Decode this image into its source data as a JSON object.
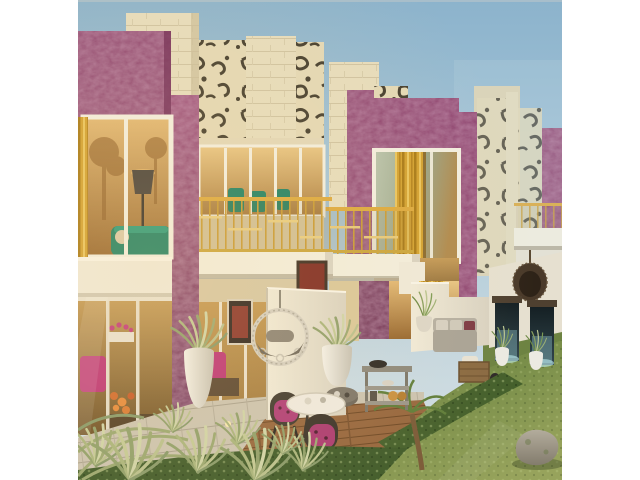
{
  "meta": {
    "kind": "architectural-rendering-photo",
    "description": "Row of modern two-storey townhouses with mottled purple feature walls, cream stone towers topped by leopard-print fretwork panels, gold balcony railings and gold curtains; landscaped ground level with white privacy walls, white planters of ornamental grass, a filigree ring swing chair, a dark hanging egg chair, wall water features, an outdoor sofa, a console cart, a round bistro table with two magenta-cushion chairs on a wood deck, stone pavers, lawn, hedges, a boulder and a small palm. White letterbox bars on left and right.",
    "image_width_px": 640,
    "image_height_px": 480,
    "content_left_px": 78,
    "content_width_px": 484
  },
  "palette": {
    "letterbox": "#ffffff",
    "sky_top": "#8cb3cc",
    "sky_horizon": "#d7e2e6",
    "wall_purple": "#8e4270",
    "wall_purple_dark": "#6e2a52",
    "stone_cream": "#e5dabb",
    "stone_shadow": "#c9bc9a",
    "leopard_spot": "#453e2f",
    "gold": "#dca93e",
    "curtain_gold": "#d2a131",
    "slab_white": "#f2eede",
    "patio_wall": "#ece6d7",
    "glass_amber": "#c8954f",
    "sofa_teal": "#1d8064",
    "accent_magenta": "#bd3577",
    "flower_orange": "#d06a2e",
    "lawn_green": "#7a8f4a",
    "hedge_green": "#45602c",
    "deck_wood": "#96663e",
    "paver_gray": "#c9c1af",
    "planter_white": "#eceae2",
    "plant_green": "#8aa060",
    "water_blue": "#9fd8e0",
    "rock_gray": "#a8a192"
  },
  "scene": {
    "objects": [
      "sky",
      "townhouse-1",
      "townhouse-2",
      "townhouse-3",
      "townhouses-far",
      "leopard-facade-panels",
      "stone-towers",
      "gold-balcony-railings",
      "gold-curtains",
      "upper-window-interior",
      "floor-lamp",
      "teal-sofa",
      "ring-swing-chair",
      "hanging-egg-chair",
      "white-planters",
      "ornamental-grasses",
      "patio-privacy-walls",
      "wall-water-features",
      "outdoor-sofa",
      "console-cart",
      "round-bistro-table",
      "bistro-chairs",
      "wood-deck",
      "stone-pavers",
      "lawn",
      "hedges",
      "boulder",
      "small-palm",
      "foreground-grasses"
    ]
  }
}
